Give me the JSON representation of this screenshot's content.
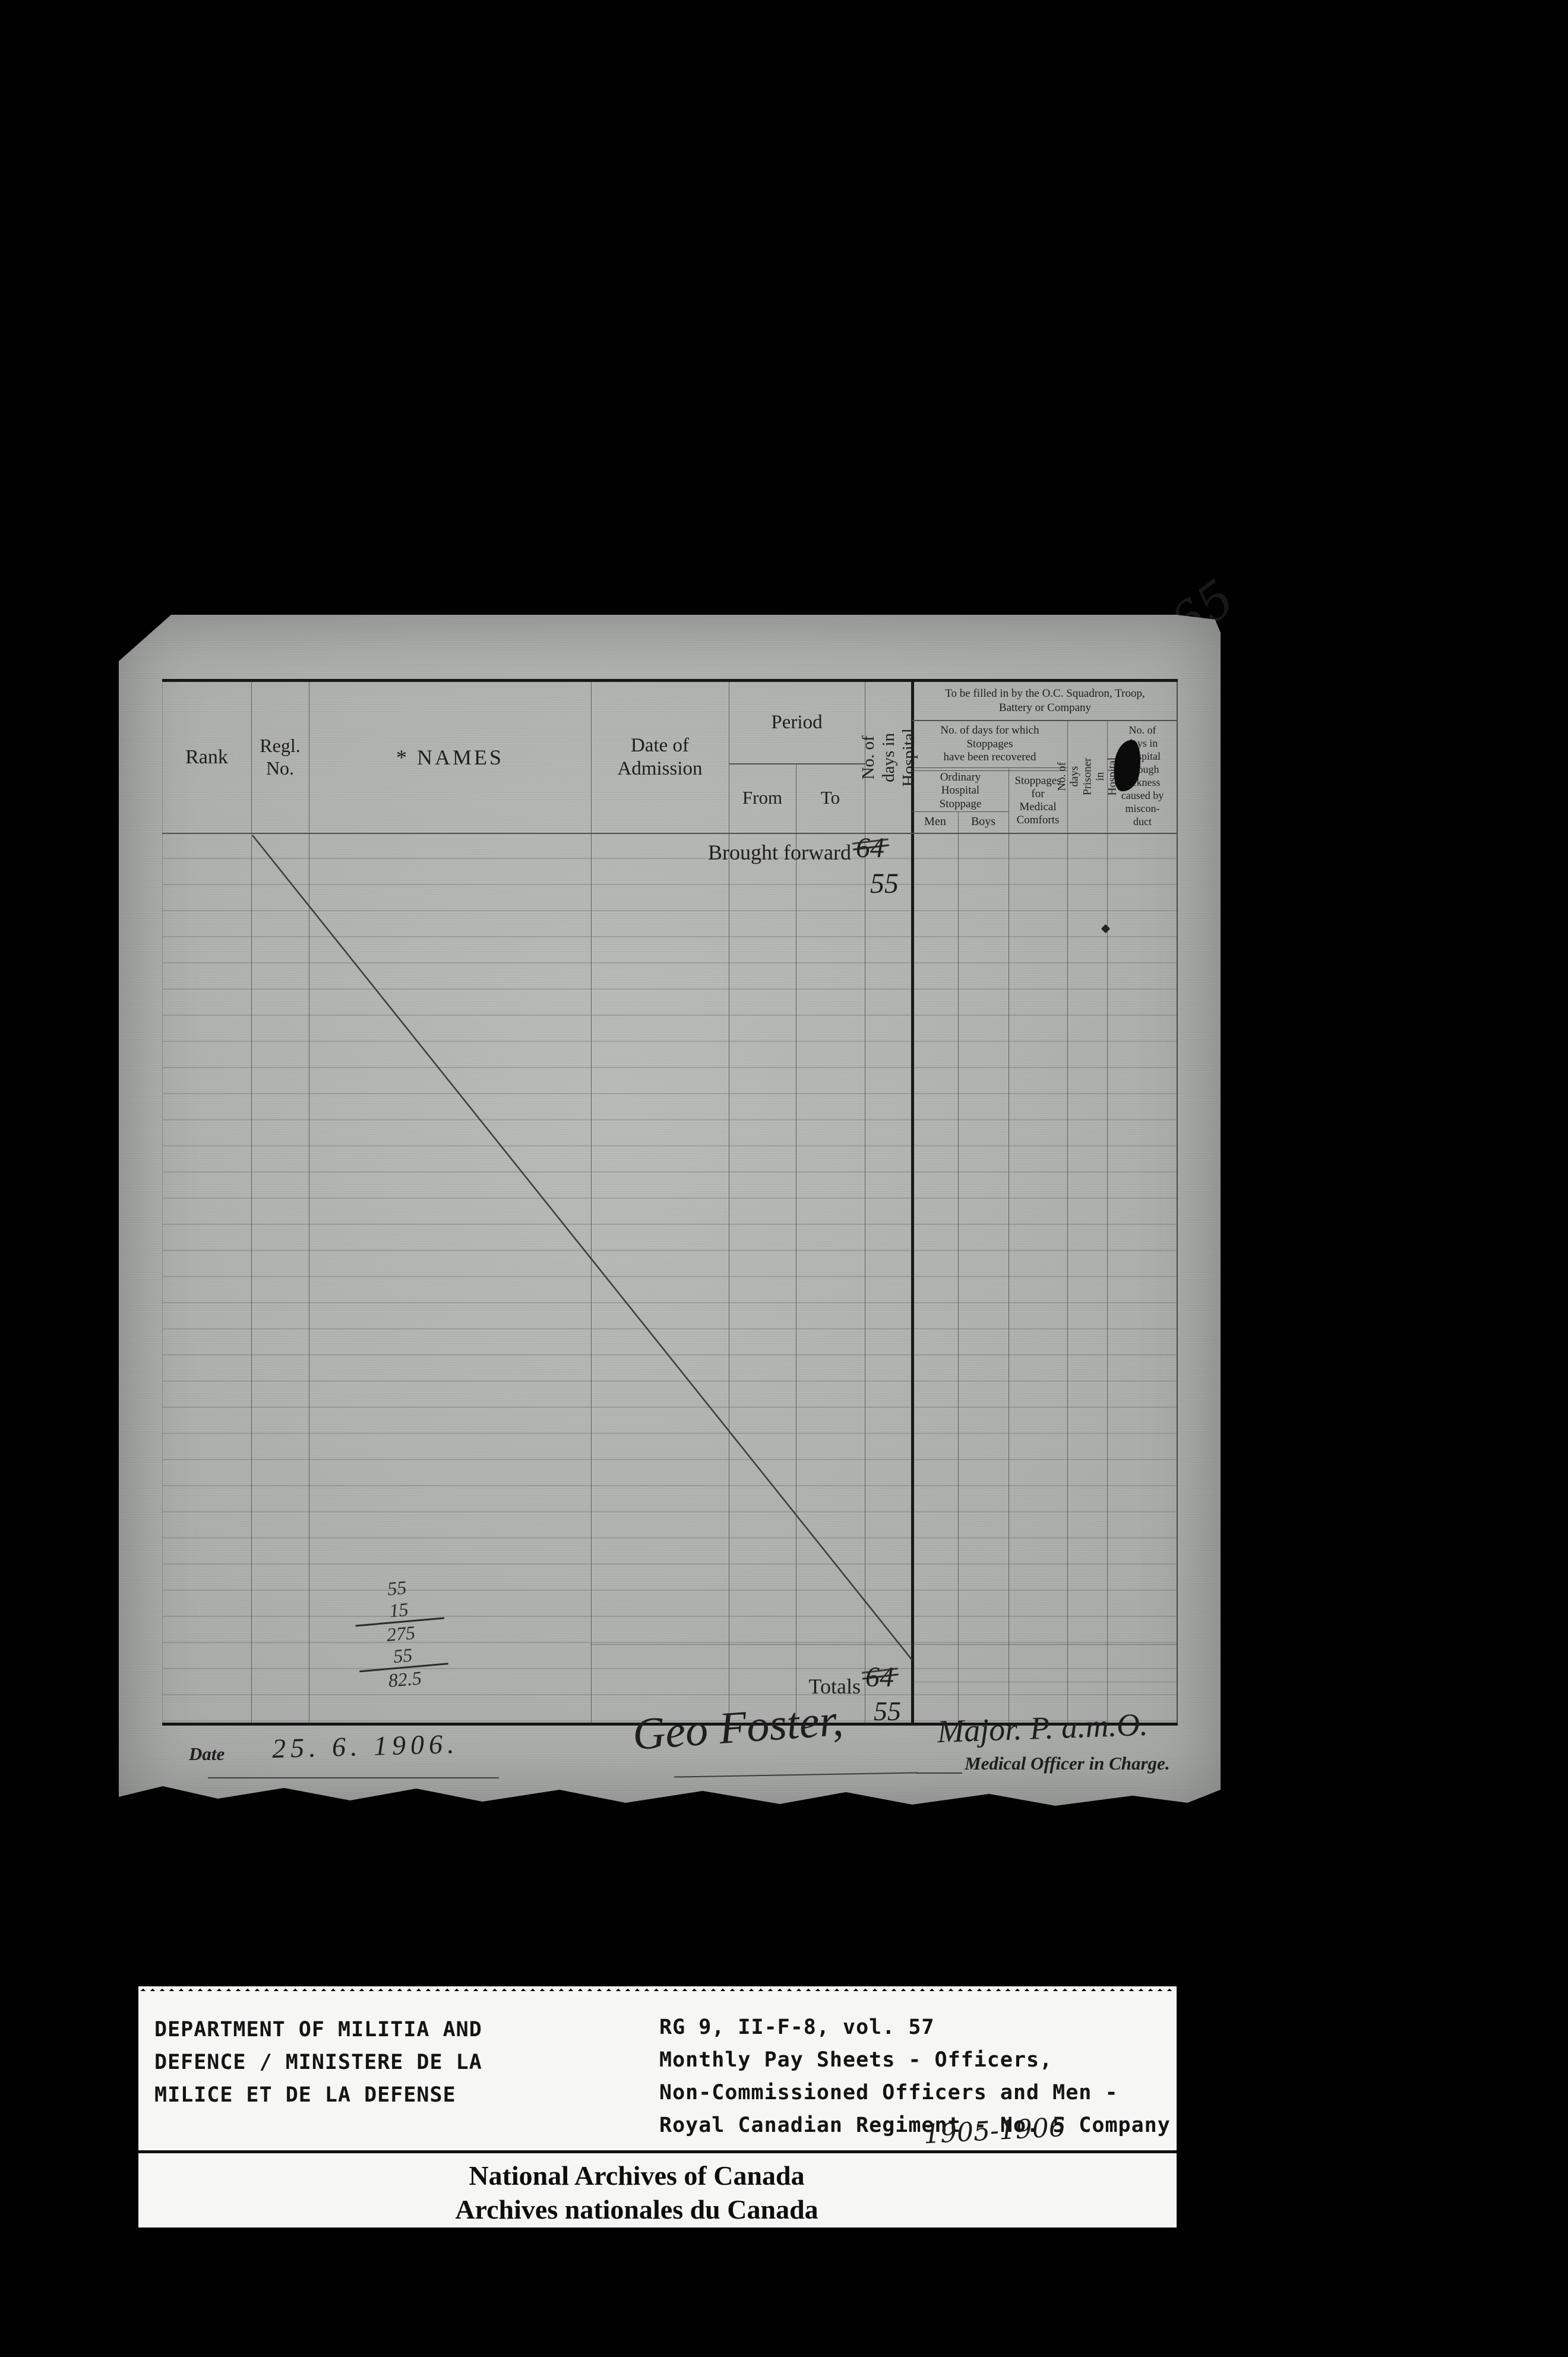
{
  "page_number": "165",
  "colors": {
    "background": "#000000",
    "paper": "#b3b6b2",
    "ink": "#1f1f1f",
    "label_bg": "#f6f6f4"
  },
  "form": {
    "header": {
      "rank": "Rank",
      "regl_no": "Regl.\nNo.",
      "names": "* NAMES",
      "date_of_admission": "Date of\nAdmission",
      "period": "Period",
      "from": "From",
      "to": "To",
      "days_in_hospital": "No. of days in Hospital",
      "oc_note": "To be filled in by the O.C. Squadron, Troop,\nBattery or Company",
      "stoppages_recovered": "No. of days for which\nStoppages\nhave been recovered",
      "ordinary_stoppage": "Ordinary\nHospital\nStoppage",
      "men": "Men",
      "boys": "Boys",
      "medical_comforts": "Stoppages\nfor\nMedical\nComforts",
      "prisoner": "No. of days\nPrisoner in\nHospital",
      "misconduct": "No. of\ndays in\nHospital\nthrough\nsickness\ncaused by\nmiscon-\nduct"
    },
    "body": {
      "brought_forward_label": "Brought forward",
      "brought_forward_crossed": "64",
      "brought_forward_value": "55",
      "totals_label": "Totals",
      "totals_crossed": "64",
      "totals_value": "55",
      "pencil_calc": [
        "55",
        "15",
        "275",
        "55",
        "82.5"
      ]
    },
    "footer": {
      "date_label": "Date",
      "date_value": "25. 6. 1906.",
      "signature": "Geo Foster,",
      "signature_rank": "Major. P. a.m.O.",
      "signature_title": "Medical Officer in Charge."
    }
  },
  "archive_labels": {
    "department": [
      "DEPARTMENT OF MILITIA AND",
      "DEFENCE / MINISTERE DE LA",
      "MILICE ET DE LA DEFENSE"
    ],
    "reference": [
      "RG 9, II-F-8, vol. 57",
      "Monthly Pay Sheets - Officers,",
      "Non-Commissioned Officers and Men -",
      "Royal Canadian Regiment - No. 5 Company"
    ],
    "years": "1905-1906",
    "archives": [
      "National Archives of Canada",
      "Archives nationales du Canada"
    ]
  }
}
